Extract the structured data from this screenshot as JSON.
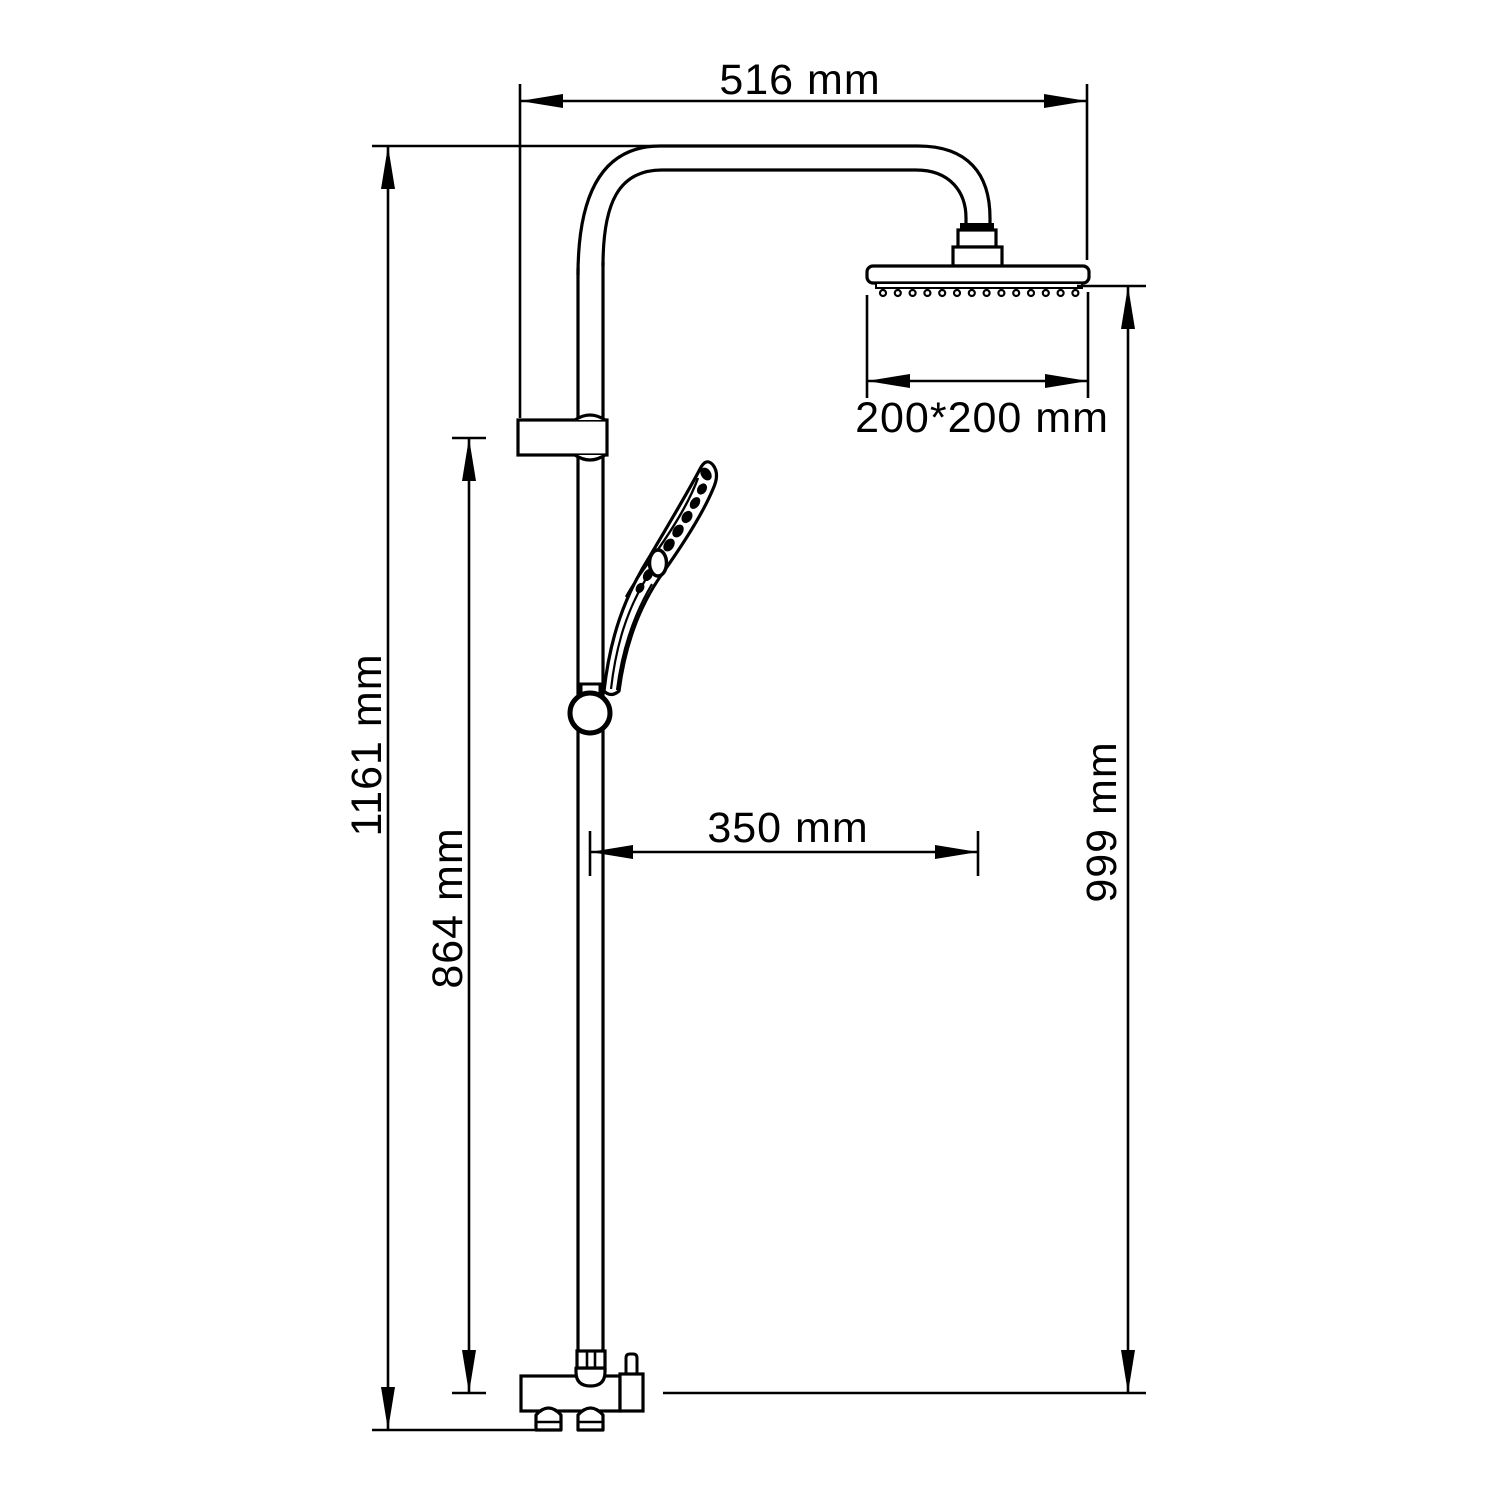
{
  "diagram": {
    "background_color": "#ffffff",
    "line_color": "#000000",
    "labels": {
      "top_width": "516 mm",
      "overall_height": "1161 mm",
      "bar_height": "864 mm",
      "right_height": "999 mm",
      "handshower_offset": "350 mm",
      "head_size": "200*200 mm"
    }
  }
}
